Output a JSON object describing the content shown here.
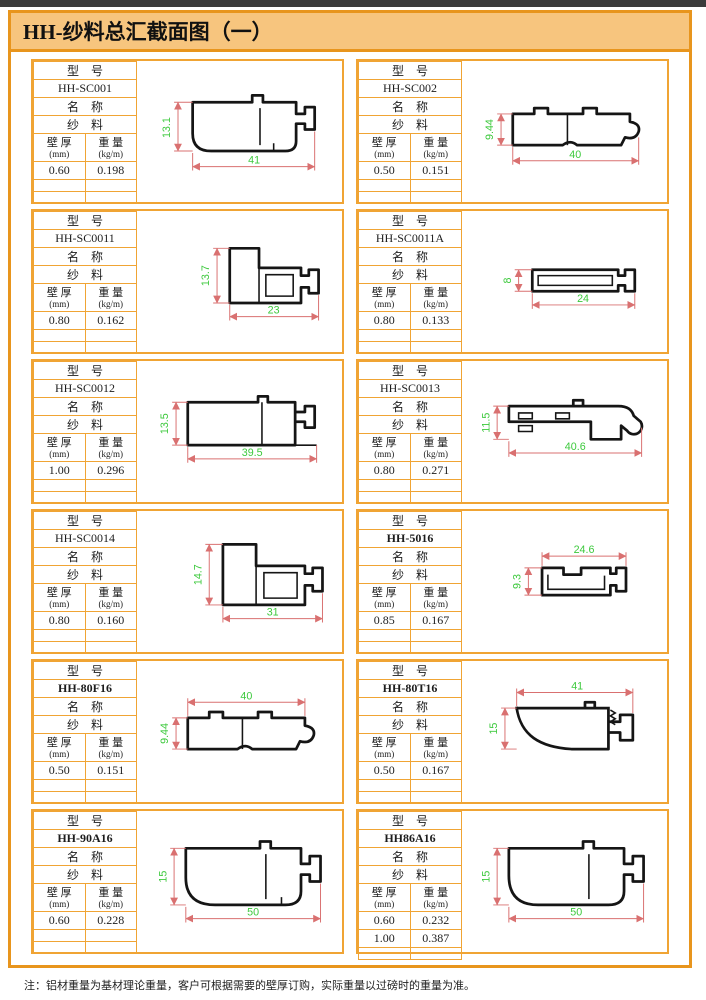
{
  "title": "HH-纱料总汇截面图（一）",
  "note": "注：铝材重量为基材理论重量，客户可根据需要的壁厚订购，实际重量以过磅时的重量为准。",
  "colors": {
    "frame_orange": "#E8951D",
    "cell_border_orange": "#F0A434",
    "title_background": "#F7C57E",
    "dimension_line_red": "#D97070",
    "dimension_text_green": "#3DC93D"
  },
  "labels": {
    "model": "型　号",
    "name": "名　称",
    "wall": "壁 厚",
    "wall_unit": "(mm)",
    "weight": "重 量",
    "weight_unit": "(kg/m)"
  },
  "cells": [
    {
      "model": "HH-SC001",
      "material": "纱　料",
      "wall": "0.60",
      "weight": "0.198",
      "dim_h": "13.1",
      "dim_w": "41"
    },
    {
      "model": "HH-SC002",
      "material": "纱　料",
      "wall": "0.50",
      "weight": "0.151",
      "dim_h": "9.44",
      "dim_w": "40"
    },
    {
      "model": "HH-SC0011",
      "material": "纱　料",
      "wall": "0.80",
      "weight": "0.162",
      "dim_h": "13.7",
      "dim_w": "23"
    },
    {
      "model": "HH-SC0011A",
      "material": "纱　料",
      "wall": "0.80",
      "weight": "0.133",
      "dim_h": "8",
      "dim_w": "24"
    },
    {
      "model": "HH-SC0012",
      "material": "纱　料",
      "wall": "1.00",
      "weight": "0.296",
      "dim_h": "13.5",
      "dim_w": "39.5"
    },
    {
      "model": "HH-SC0013",
      "material": "纱　料",
      "wall": "0.80",
      "weight": "0.271",
      "dim_h": "11.5",
      "dim_w": "40.6"
    },
    {
      "model": "HH-SC0014",
      "material": "纱　料",
      "wall": "0.80",
      "weight": "0.160",
      "dim_h": "14.7",
      "dim_w": "31"
    },
    {
      "model": "HH-5016",
      "material": "纱　料",
      "wall": "0.85",
      "weight": "0.167",
      "dim_h": "9.3",
      "dim_w": "24.6"
    },
    {
      "model": "HH-80F16",
      "material": "纱　料",
      "wall": "0.50",
      "weight": "0.151",
      "dim_h": "9.44",
      "dim_w": "40"
    },
    {
      "model": "HH-80T16",
      "material": "纱　料",
      "wall": "0.50",
      "weight": "0.167",
      "dim_h": "15",
      "dim_w": "41"
    },
    {
      "model": "HH-90A16",
      "material": "纱　料",
      "wall": "0.60",
      "weight": "0.228",
      "dim_h": "15",
      "dim_w": "50"
    },
    {
      "model": "HH86A16",
      "material": "纱　料",
      "wall": "0.60",
      "weight": "0.232",
      "wall2": "1.00",
      "weight2": "0.387",
      "dim_h": "15",
      "dim_w": "50"
    }
  ]
}
